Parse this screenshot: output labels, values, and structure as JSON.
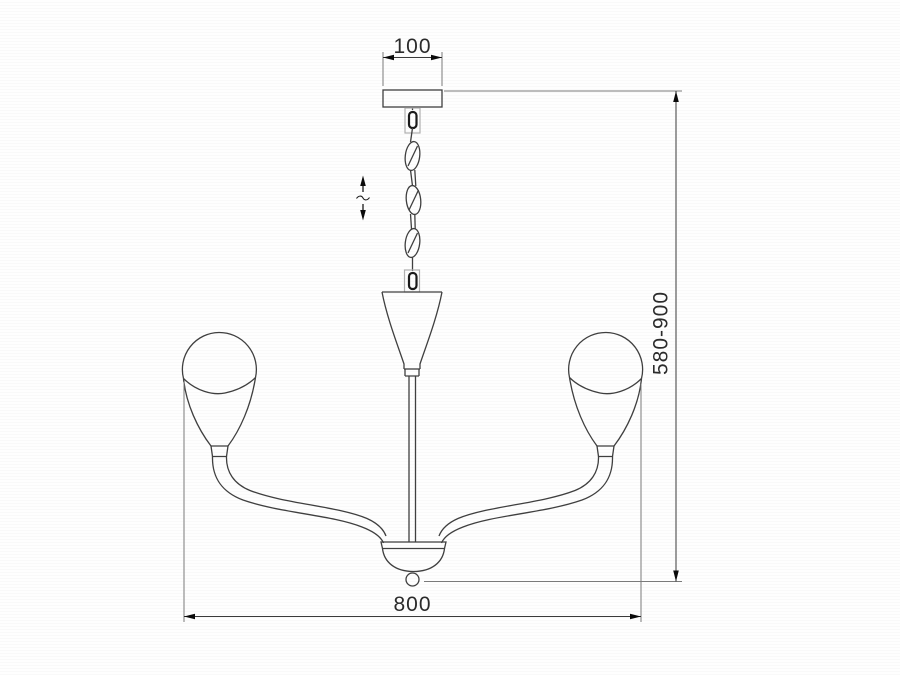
{
  "page": {
    "background": "#fcfcfc"
  },
  "drawing": {
    "subject": "two-arm chandelier front elevation",
    "type": "technical dimension drawing",
    "line_color": "#3f3f3f",
    "dimension_text_color": "#2b2b2b",
    "labels": {
      "canopy_width_mm": "100",
      "overall_width_mm": "800",
      "hanging_height_mm": "580-900"
    },
    "annotations": {
      "height_adjustable_icon": "vertical-double-arrow-with-tilde"
    }
  }
}
